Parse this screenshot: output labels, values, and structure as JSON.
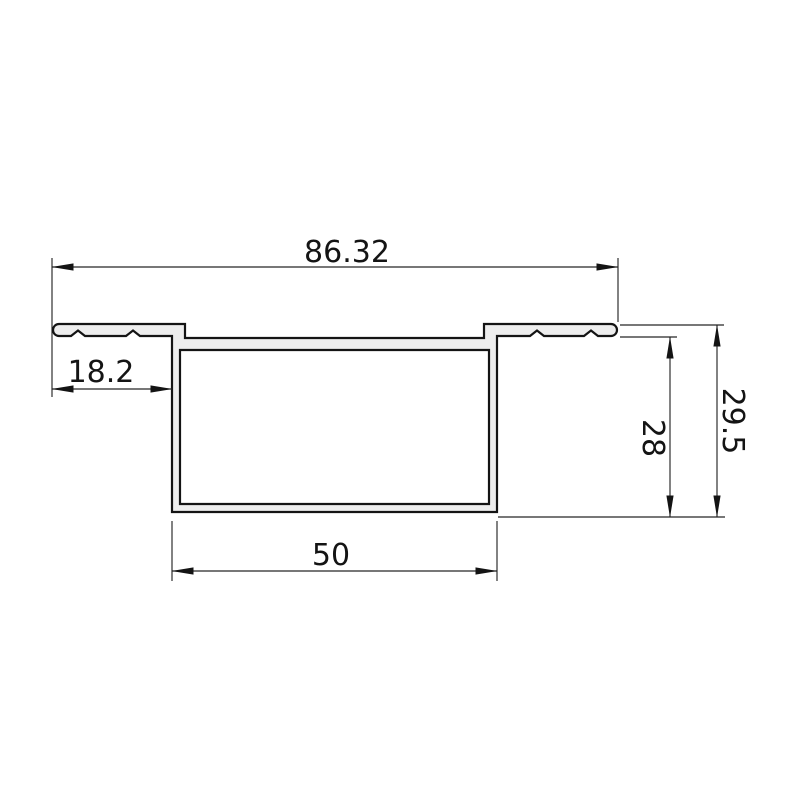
{
  "drawing": {
    "type": "technical-cross-section",
    "subject": "recessed aluminum channel profile with serrated mounting flanges",
    "dimensions": {
      "overall_width": "86.32",
      "flange_width": "18.2",
      "inner_height": "28",
      "overall_height": "29.5",
      "bottom_width": "50"
    },
    "colors": {
      "background": "#ffffff",
      "profile_fill": "#ededed",
      "profile_outline": "#141414",
      "dimension_lines": "#262626",
      "text": "#141414"
    }
  }
}
